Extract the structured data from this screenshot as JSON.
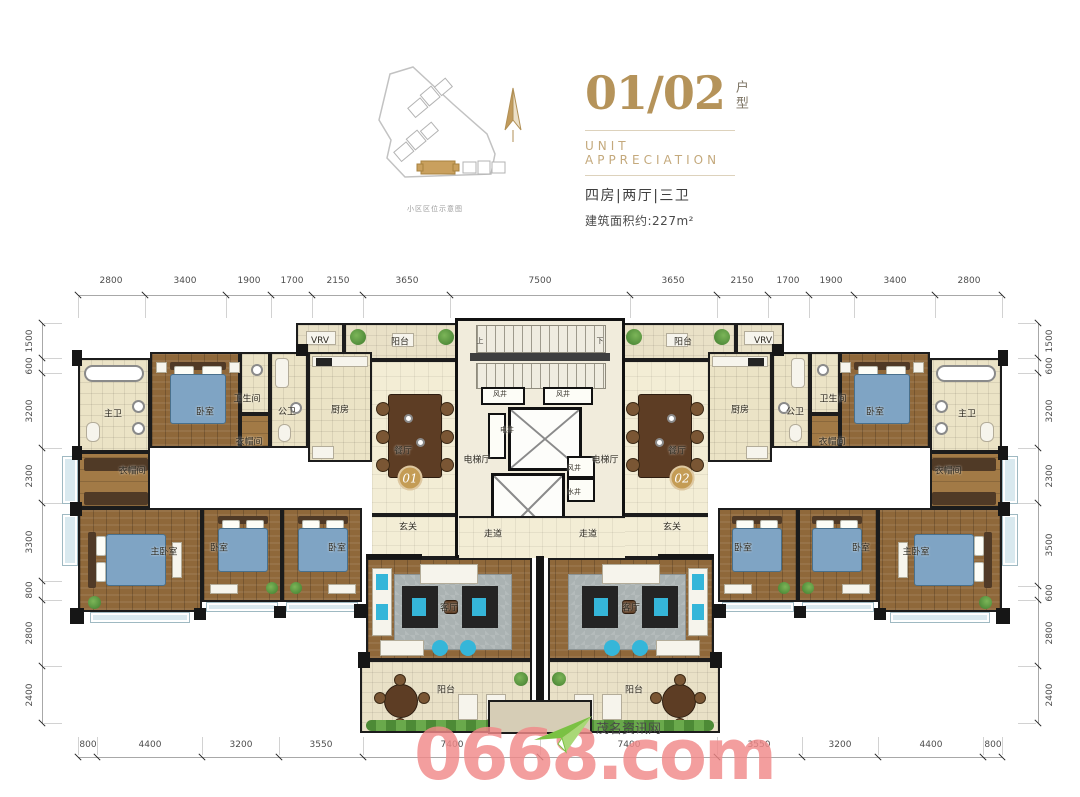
{
  "site_plan": {
    "caption": "小区区位示意图",
    "highlight_color": "#c9a05e",
    "compass": "north-arrow"
  },
  "title_block": {
    "unit_number": "01/02",
    "unit_label": "户型",
    "subtitle_en": "UNIT APPRECIATION",
    "layout_spec": "四房|两厅|三卫",
    "area_text": "建筑面积约:227m²",
    "accent_color": "#b5935a"
  },
  "dimensions": {
    "top": {
      "line_y": 295,
      "num_y": 281,
      "ticks": [
        78,
        145,
        226,
        271,
        312,
        363,
        450,
        630,
        717,
        768,
        809,
        854,
        935,
        1002
      ],
      "labels": [
        {
          "v": "2800",
          "p": 111
        },
        {
          "v": "3400",
          "p": 185
        },
        {
          "v": "1900",
          "p": 249
        },
        {
          "v": "1700",
          "p": 292
        },
        {
          "v": "2150",
          "p": 338
        },
        {
          "v": "3650",
          "p": 407
        },
        {
          "v": "7500",
          "p": 540
        },
        {
          "v": "3650",
          "p": 673
        },
        {
          "v": "2150",
          "p": 742
        },
        {
          "v": "1700",
          "p": 788
        },
        {
          "v": "1900",
          "p": 831
        },
        {
          "v": "3400",
          "p": 895
        },
        {
          "v": "2800",
          "p": 969
        }
      ]
    },
    "bottom": {
      "line_y": 757,
      "num_y": 745,
      "ticks": [
        78,
        97,
        202,
        279,
        363,
        540,
        717,
        802,
        878,
        983,
        1002
      ],
      "labels": [
        {
          "v": "800",
          "p": 88
        },
        {
          "v": "4400",
          "p": 150
        },
        {
          "v": "3200",
          "p": 241
        },
        {
          "v": "3550",
          "p": 321
        },
        {
          "v": "7400",
          "p": 452
        },
        {
          "v": "7400",
          "p": 629
        },
        {
          "v": "3550",
          "p": 759
        },
        {
          "v": "3200",
          "p": 840
        },
        {
          "v": "4400",
          "p": 931
        },
        {
          "v": "800",
          "p": 993
        }
      ]
    },
    "left": {
      "line_x": 42,
      "num_x": 30,
      "ticks": [
        323,
        358,
        373,
        448,
        503,
        581,
        600,
        666,
        723
      ],
      "labels": [
        {
          "v": "1500",
          "p": 341
        },
        {
          "v": "600",
          "p": 366
        },
        {
          "v": "3200",
          "p": 411
        },
        {
          "v": "2300",
          "p": 476
        },
        {
          "v": "3300",
          "p": 542
        },
        {
          "v": "800",
          "p": 590
        },
        {
          "v": "2800",
          "p": 633
        },
        {
          "v": "2400",
          "p": 695
        }
      ]
    },
    "right": {
      "line_x": 1038,
      "num_x": 1050,
      "ticks": [
        323,
        358,
        373,
        448,
        503,
        586,
        600,
        666,
        723
      ],
      "labels": [
        {
          "v": "1500",
          "p": 341
        },
        {
          "v": "600",
          "p": 366
        },
        {
          "v": "3200",
          "p": 411
        },
        {
          "v": "2300",
          "p": 476
        },
        {
          "v": "3500",
          "p": 545
        },
        {
          "v": "600",
          "p": 593
        },
        {
          "v": "2800",
          "p": 633
        },
        {
          "v": "2400",
          "p": 695
        }
      ]
    }
  },
  "floorplan": {
    "unit_badges": [
      {
        "label": "01",
        "x": 410,
        "y": 478
      },
      {
        "label": "02",
        "x": 682,
        "y": 478
      }
    ],
    "labels": [
      {
        "t": "VRV",
        "x": 320,
        "y": 341
      },
      {
        "t": "阳台",
        "x": 400,
        "y": 341
      },
      {
        "t": "主卫",
        "x": 113,
        "y": 413
      },
      {
        "t": "卧室",
        "x": 205,
        "y": 411
      },
      {
        "t": "卫生间",
        "x": 247,
        "y": 398
      },
      {
        "t": "公卫",
        "x": 287,
        "y": 411
      },
      {
        "t": "厨房",
        "x": 340,
        "y": 409
      },
      {
        "t": "衣帽间",
        "x": 249,
        "y": 441
      },
      {
        "t": "衣帽间",
        "x": 132,
        "y": 470
      },
      {
        "t": "餐厅",
        "x": 403,
        "y": 450
      },
      {
        "t": "玄关",
        "x": 408,
        "y": 526
      },
      {
        "t": "客厅",
        "x": 449,
        "y": 607
      },
      {
        "t": "阳台",
        "x": 446,
        "y": 689
      },
      {
        "t": "主卧室",
        "x": 164,
        "y": 551
      },
      {
        "t": "卧室",
        "x": 219,
        "y": 547
      },
      {
        "t": "卧室",
        "x": 337,
        "y": 547
      },
      {
        "t": "上",
        "x": 480,
        "y": 341,
        "s": 1
      },
      {
        "t": "下",
        "x": 600,
        "y": 341,
        "s": 1
      },
      {
        "t": "风井",
        "x": 500,
        "y": 394,
        "s": 1
      },
      {
        "t": "风井",
        "x": 563,
        "y": 394,
        "s": 1
      },
      {
        "t": "电井",
        "x": 507,
        "y": 430,
        "s": 1
      },
      {
        "t": "电梯厅",
        "x": 477,
        "y": 459
      },
      {
        "t": "电梯厅",
        "x": 605,
        "y": 459
      },
      {
        "t": "风井",
        "x": 574,
        "y": 468,
        "s": 1
      },
      {
        "t": "水井",
        "x": 574,
        "y": 492,
        "s": 1
      },
      {
        "t": "走道",
        "x": 493,
        "y": 533
      },
      {
        "t": "走道",
        "x": 588,
        "y": 533
      },
      {
        "t": "阳台",
        "x": 683,
        "y": 341
      },
      {
        "t": "VRV",
        "x": 763,
        "y": 341
      },
      {
        "t": "厨房",
        "x": 740,
        "y": 409
      },
      {
        "t": "公卫",
        "x": 795,
        "y": 411
      },
      {
        "t": "卫生间",
        "x": 833,
        "y": 398
      },
      {
        "t": "卧室",
        "x": 875,
        "y": 411
      },
      {
        "t": "主卫",
        "x": 967,
        "y": 413
      },
      {
        "t": "衣帽间",
        "x": 832,
        "y": 441
      },
      {
        "t": "衣帽间",
        "x": 948,
        "y": 470
      },
      {
        "t": "餐厅",
        "x": 677,
        "y": 450
      },
      {
        "t": "玄关",
        "x": 672,
        "y": 526
      },
      {
        "t": "客厅",
        "x": 631,
        "y": 607
      },
      {
        "t": "阳台",
        "x": 634,
        "y": 689
      },
      {
        "t": "卧室",
        "x": 743,
        "y": 547
      },
      {
        "t": "卧室",
        "x": 861,
        "y": 547
      },
      {
        "t": "主卧室",
        "x": 916,
        "y": 551
      }
    ]
  },
  "watermark": {
    "text": "0668.com",
    "site_name": "茂名资讯网",
    "color": "#f08989"
  }
}
